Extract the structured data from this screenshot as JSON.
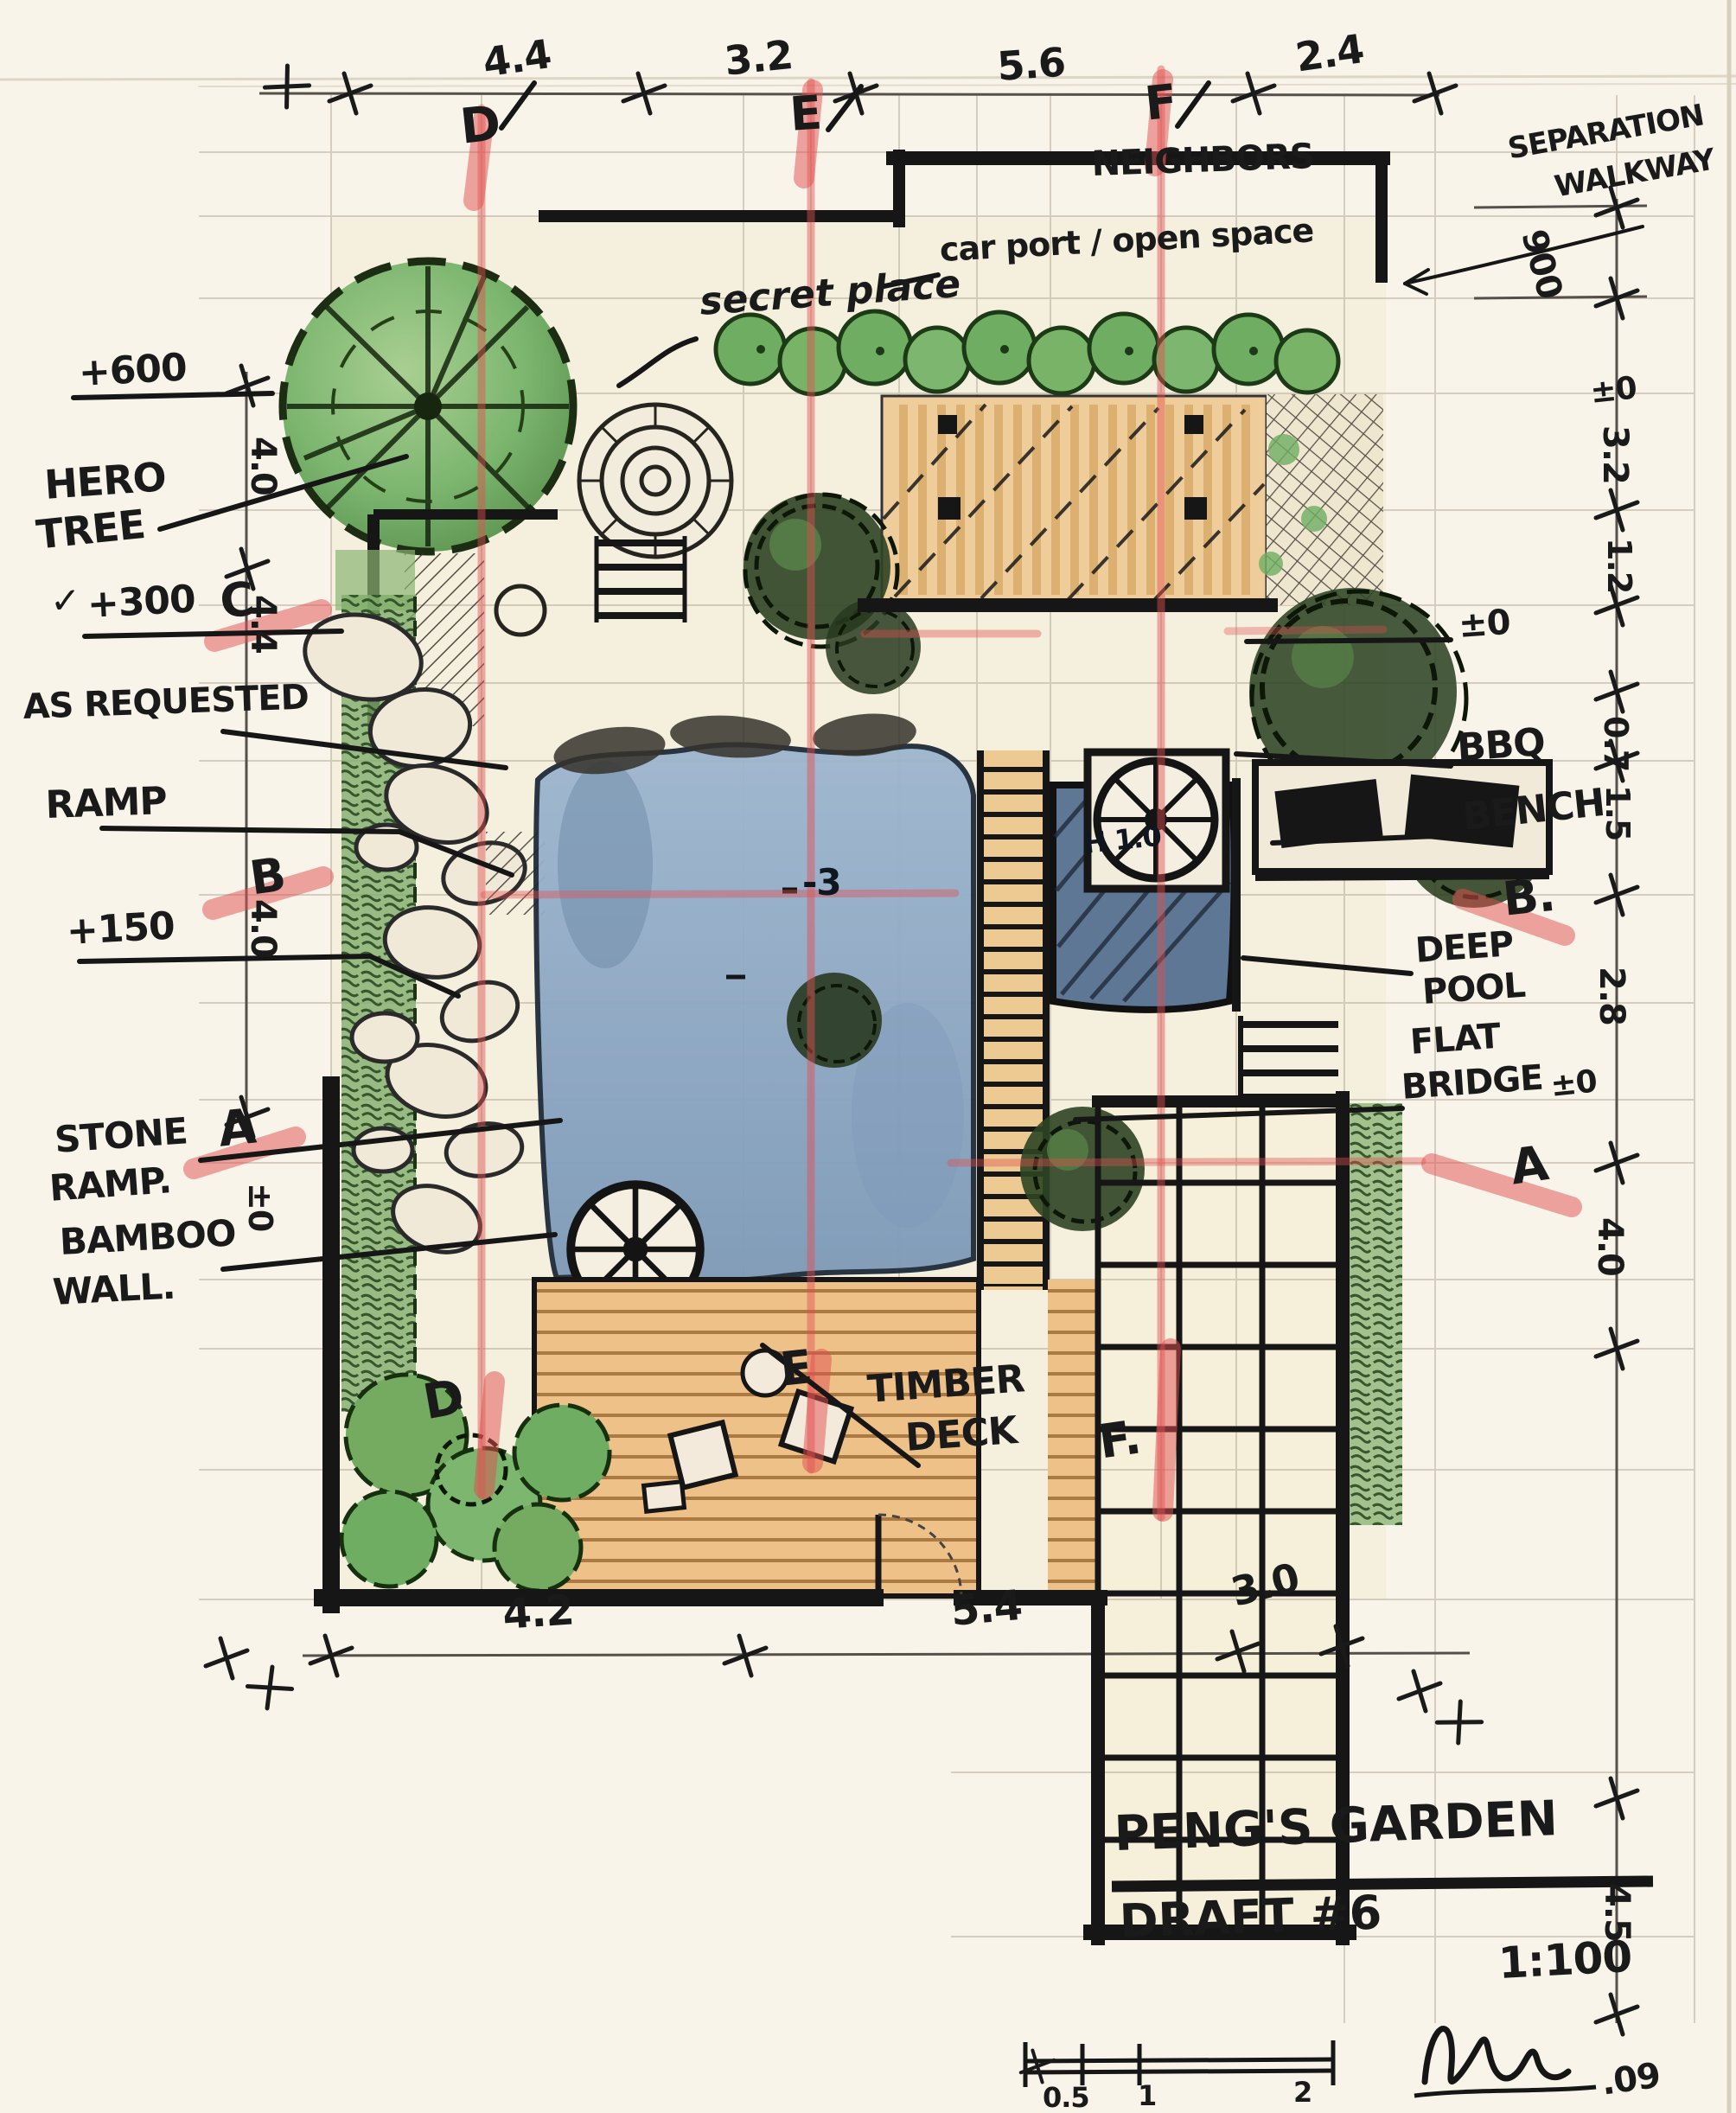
{
  "title_block": {
    "project_title": "PENG'S GARDEN",
    "draft_label": "DRAFT #6",
    "scale_label": "1:100",
    "date_note": ".09",
    "scale_bar_labels": [
      "0.5",
      "1",
      "2"
    ]
  },
  "plan_labels": {
    "neighbors": "NEIGHBORS",
    "separation_walkway_1": "SEPARATION",
    "separation_walkway_2": "WALKWAY",
    "secret_place": "secret place",
    "carport": "car port / open space",
    "hero_tree_1": "HERO",
    "hero_tree_2": "TREE",
    "as_requested": "AS REQUESTED",
    "ramp": "RAMP",
    "stone_ramp_1": "STONE",
    "stone_ramp_2": "RAMP.",
    "bamboo_wall_1": "BAMBOO",
    "bamboo_wall_2": "WALL.",
    "bbq": "BBQ",
    "bench": "BENCH",
    "deep_pool_1": "DEEP",
    "deep_pool_2": "POOL",
    "flat_bridge_1": "FLAT",
    "flat_bridge_2": "BRIDGE",
    "timber_deck_1": "TIMBER",
    "timber_deck_2": "DECK",
    "pool_depth": "-3",
    "water_mark": "H 1.0"
  },
  "levels": {
    "plus600": "+600",
    "plus300": "+300",
    "plus150": "+150",
    "plus900": "900",
    "datum": "±0",
    "check": "✓"
  },
  "dimensions": {
    "top": [
      "4.4",
      "3.2",
      "5.6",
      "2.4"
    ],
    "bottom": [
      "4.2",
      "5.4",
      "3.0"
    ],
    "left": [
      "4.0",
      "4.4",
      "4.0"
    ],
    "right": [
      "3.2",
      "1.2",
      "0.7",
      "1.5",
      "2.8",
      "4.0",
      "4.5"
    ]
  },
  "section_markers": {
    "top": [
      "D",
      "E",
      "F"
    ],
    "bottom": [
      "D",
      "E",
      "F."
    ],
    "left": [
      "C",
      "B",
      "A"
    ],
    "right": [
      "B.",
      "A"
    ]
  },
  "colors": {
    "paper": "#f8f4ea",
    "ink": "#1a1a1a",
    "red_marker": "#e05050",
    "pool_blue": "#8aa6c2",
    "deep_pool_blue": "#5d7795",
    "tree_green": "#7cb66f",
    "deck_tan": "#eec189",
    "carport_tan": "#efcd9a"
  }
}
